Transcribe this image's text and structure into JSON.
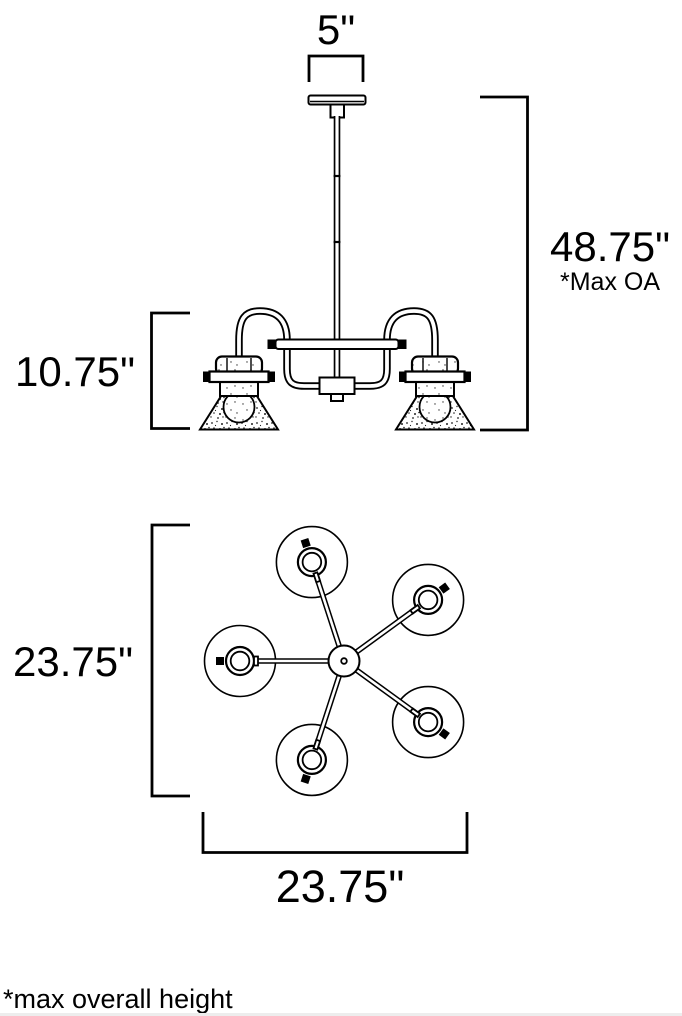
{
  "colors": {
    "line": "#000000",
    "background": "#ffffff"
  },
  "side_view": {
    "canopy_width_label": "5\"",
    "overall_height_label": "48.75\"",
    "overall_height_note": "*Max OA",
    "body_height_label": "10.75\""
  },
  "top_view": {
    "height_label": "23.75\"",
    "width_label": "23.75\""
  },
  "footnote": "*max overall height"
}
